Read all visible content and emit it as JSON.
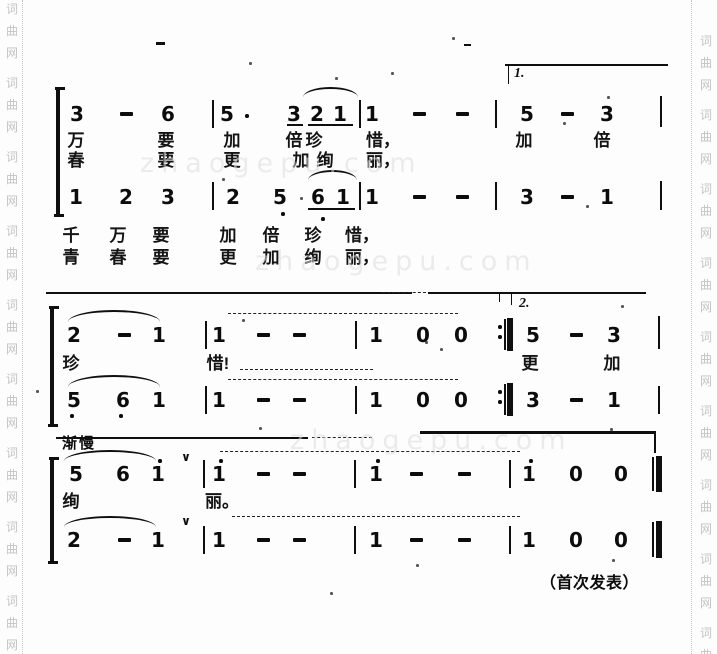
{
  "meta": {
    "footer": "（首次发表）",
    "volta1": "1.",
    "volta2": "2.",
    "tempo": "渐慢",
    "breath": "∨",
    "site_watermark": "词曲网",
    "diagonal_watermark": "zhaogepu.com"
  },
  "watermark": {
    "chars": [
      "词",
      "曲",
      "网"
    ],
    "left": {
      "x": 4,
      "start": 2,
      "step": 74,
      "gap": 22,
      "groups": 9
    },
    "right": {
      "x": 698,
      "start": 34,
      "step": 74,
      "gap": 22,
      "groups": 9
    }
  },
  "score": {
    "rows": [
      {
        "n": "s1-voice1",
        "cls": "num",
        "y": 103,
        "tokens": [
          {
            "t": "3",
            "x": 77
          },
          {
            "t": "-",
            "x": 126
          },
          {
            "t": "6",
            "x": 168
          },
          {
            "t": "5",
            "x": 227
          },
          {
            "t": "3",
            "x": 294
          },
          {
            "t": "2",
            "x": 317
          },
          {
            "t": "1",
            "x": 340
          },
          {
            "t": "1",
            "x": 372
          },
          {
            "t": "-",
            "x": 419
          },
          {
            "t": "-",
            "x": 462
          },
          {
            "t": "5",
            "x": 527
          },
          {
            "t": "-",
            "x": 567
          },
          {
            "t": "3",
            "x": 607
          }
        ]
      },
      {
        "n": "s1-lyric-1",
        "cls": "lyr",
        "y": 131,
        "tokens": [
          {
            "t": "万",
            "x": 76
          },
          {
            "t": "要",
            "x": 166
          },
          {
            "t": "加",
            "x": 232
          },
          {
            "t": "倍",
            "x": 294
          },
          {
            "t": "珍",
            "x": 314
          },
          {
            "t": "惜，",
            "x": 383
          },
          {
            "t": "加",
            "x": 524
          },
          {
            "t": "倍",
            "x": 602
          }
        ]
      },
      {
        "n": "s1-lyric-2",
        "cls": "lyr",
        "y": 151,
        "tokens": [
          {
            "t": "春",
            "x": 76
          },
          {
            "t": "要",
            "x": 166
          },
          {
            "t": "更",
            "x": 232
          },
          {
            "t": "加",
            "x": 301
          },
          {
            "t": "绚",
            "x": 325
          },
          {
            "t": "丽，",
            "x": 383
          }
        ]
      },
      {
        "n": "s1-voice2",
        "cls": "num",
        "y": 186,
        "tokens": [
          {
            "t": "1",
            "x": 76
          },
          {
            "t": "2",
            "x": 126
          },
          {
            "t": "3",
            "x": 168
          },
          {
            "t": "2",
            "x": 233
          },
          {
            "t": "5",
            "x": 280
          },
          {
            "t": "6",
            "x": 318
          },
          {
            "t": "1",
            "x": 343
          },
          {
            "t": "1",
            "x": 372
          },
          {
            "t": "-",
            "x": 419
          },
          {
            "t": "-",
            "x": 462
          },
          {
            "t": "3",
            "x": 527
          },
          {
            "t": "-",
            "x": 567
          },
          {
            "t": "1",
            "x": 607
          }
        ]
      },
      {
        "n": "s1-lyric-3",
        "cls": "lyr",
        "y": 226,
        "tokens": [
          {
            "t": "千",
            "x": 71
          },
          {
            "t": "万",
            "x": 118
          },
          {
            "t": "要",
            "x": 161
          },
          {
            "t": "加",
            "x": 228
          },
          {
            "t": "倍",
            "x": 271
          },
          {
            "t": "珍",
            "x": 313
          },
          {
            "t": "惜，",
            "x": 362
          }
        ]
      },
      {
        "n": "s1-lyric-4",
        "cls": "lyr",
        "y": 248,
        "tokens": [
          {
            "t": "青",
            "x": 71
          },
          {
            "t": "春",
            "x": 118
          },
          {
            "t": "要",
            "x": 161
          },
          {
            "t": "更",
            "x": 228
          },
          {
            "t": "加",
            "x": 271
          },
          {
            "t": "绚",
            "x": 313
          },
          {
            "t": "丽，",
            "x": 362
          }
        ]
      },
      {
        "n": "s2-voice1",
        "cls": "num",
        "y": 324,
        "tokens": [
          {
            "t": "2",
            "x": 74
          },
          {
            "t": "-",
            "x": 124
          },
          {
            "t": "1",
            "x": 159
          },
          {
            "t": "1",
            "x": 219
          },
          {
            "t": "-",
            "x": 263
          },
          {
            "t": "-",
            "x": 299
          },
          {
            "t": "1",
            "x": 376
          },
          {
            "t": "0",
            "x": 423
          },
          {
            "t": "0",
            "x": 461
          },
          {
            "t": "5",
            "x": 533
          },
          {
            "t": "-",
            "x": 576
          },
          {
            "t": "3",
            "x": 614
          }
        ]
      },
      {
        "n": "s2-lyric",
        "cls": "lyr",
        "y": 354,
        "tokens": [
          {
            "t": "珍",
            "x": 71
          },
          {
            "t": "惜!",
            "x": 218
          },
          {
            "t": "更",
            "x": 530
          },
          {
            "t": "加",
            "x": 612
          }
        ]
      },
      {
        "n": "s2-voice2",
        "cls": "num",
        "y": 389,
        "tokens": [
          {
            "t": "5",
            "x": 74
          },
          {
            "t": "6",
            "x": 123
          },
          {
            "t": "1",
            "x": 159
          },
          {
            "t": "1",
            "x": 219
          },
          {
            "t": "-",
            "x": 263
          },
          {
            "t": "-",
            "x": 299
          },
          {
            "t": "1",
            "x": 376
          },
          {
            "t": "0",
            "x": 423
          },
          {
            "t": "0",
            "x": 461
          },
          {
            "t": "3",
            "x": 533
          },
          {
            "t": "-",
            "x": 576
          },
          {
            "t": "1",
            "x": 614
          }
        ]
      },
      {
        "n": "s3-voice1",
        "cls": "num",
        "y": 463,
        "tokens": [
          {
            "t": "5",
            "x": 76
          },
          {
            "t": "6",
            "x": 123
          },
          {
            "t": "1",
            "x": 158
          },
          {
            "t": "1",
            "x": 219
          },
          {
            "t": "-",
            "x": 263
          },
          {
            "t": "-",
            "x": 299
          },
          {
            "t": "1",
            "x": 376
          },
          {
            "t": "-",
            "x": 416
          },
          {
            "t": "-",
            "x": 464
          },
          {
            "t": "1",
            "x": 529
          },
          {
            "t": "0",
            "x": 576
          },
          {
            "t": "0",
            "x": 621
          }
        ]
      },
      {
        "n": "s3-lyric",
        "cls": "lyr",
        "y": 492,
        "tokens": [
          {
            "t": "绚",
            "x": 71
          },
          {
            "t": "丽。",
            "x": 222
          }
        ]
      },
      {
        "n": "s3-voice2",
        "cls": "num",
        "y": 529,
        "tokens": [
          {
            "t": "2",
            "x": 74
          },
          {
            "t": "-",
            "x": 124
          },
          {
            "t": "1",
            "x": 158
          },
          {
            "t": "1",
            "x": 219
          },
          {
            "t": "-",
            "x": 263
          },
          {
            "t": "-",
            "x": 299
          },
          {
            "t": "1",
            "x": 376
          },
          {
            "t": "-",
            "x": 416
          },
          {
            "t": "-",
            "x": 464
          },
          {
            "t": "1",
            "x": 529
          },
          {
            "t": "0",
            "x": 576
          },
          {
            "t": "0",
            "x": 621
          }
        ]
      }
    ],
    "marks": [
      {
        "ty": "v",
        "x": 56,
        "y": 89,
        "w": 4,
        "h": 127,
        "n": "voice-brace"
      },
      {
        "ty": "h",
        "x": 55,
        "y": 87,
        "w": 10,
        "h": 2.5,
        "n": "brace-hook"
      },
      {
        "ty": "h",
        "x": 54,
        "y": 214,
        "w": 10,
        "h": 2.5,
        "n": "brace-hook"
      },
      {
        "ty": "v",
        "x": 212,
        "y": 100,
        "h": 28
      },
      {
        "ty": "v",
        "x": 359,
        "y": 100,
        "h": 28
      },
      {
        "ty": "v",
        "x": 495,
        "y": 100,
        "h": 28
      },
      {
        "ty": "v",
        "x": 660,
        "y": 96,
        "h": 31
      },
      {
        "ty": "v",
        "x": 212,
        "y": 182,
        "h": 28
      },
      {
        "ty": "v",
        "x": 359,
        "y": 182,
        "h": 28
      },
      {
        "ty": "v",
        "x": 495,
        "y": 182,
        "h": 28
      },
      {
        "ty": "v",
        "x": 660,
        "y": 181,
        "h": 29
      },
      {
        "ty": "h",
        "x": 505,
        "y": 64,
        "w": 163,
        "h": 2,
        "n": "volta-bracket"
      },
      {
        "ty": "v",
        "x": 508,
        "y": 66,
        "w": 1.2,
        "h": 18,
        "n": "volta-bracket"
      },
      {
        "ty": "h",
        "x": 287,
        "y": 124,
        "w": 16,
        "h": 2,
        "n": "beam-underline"
      },
      {
        "ty": "h",
        "x": 308,
        "y": 124,
        "w": 45,
        "h": 2,
        "n": "beam-underline"
      },
      {
        "ty": "h",
        "x": 308,
        "y": 208,
        "w": 47,
        "h": 2,
        "n": "beam-underline"
      },
      {
        "ty": "a",
        "x": 303,
        "y": 87,
        "w": 55,
        "h": 11
      },
      {
        "ty": "a",
        "x": 308,
        "y": 170,
        "w": 49,
        "h": 11
      },
      {
        "ty": "d",
        "x": 245,
        "y": 114,
        "n": "augmentation-dot"
      },
      {
        "ty": "d",
        "x": 281,
        "y": 212,
        "n": "octave-dot-low"
      },
      {
        "ty": "d",
        "x": 321,
        "y": 217,
        "n": "octave-dot-low"
      },
      {
        "ty": "h",
        "x": 156,
        "y": 42,
        "w": 9,
        "h": 2.5,
        "n": "stray-mark"
      },
      {
        "ty": "h",
        "x": 464,
        "y": 44,
        "w": 7,
        "h": 2,
        "n": "stray-mark"
      },
      {
        "ty": "h",
        "x": 46,
        "y": 292,
        "w": 366,
        "h": 2,
        "n": "separator-line"
      },
      {
        "ty": "h",
        "x": 382,
        "y": 292,
        "w": 44,
        "h": 1.5,
        "d": 1,
        "n": "separator-line"
      },
      {
        "ty": "h",
        "x": 428,
        "y": 292,
        "w": 218,
        "h": 2,
        "n": "separator-line"
      },
      {
        "ty": "v",
        "x": 499,
        "y": 294,
        "w": 1.2,
        "h": 8,
        "n": "volta-bracket"
      },
      {
        "ty": "v",
        "x": 511,
        "y": 294,
        "w": 1.2,
        "h": 11,
        "n": "volta-bracket"
      },
      {
        "ty": "v",
        "x": 50,
        "y": 308,
        "w": 4,
        "h": 118,
        "n": "voice-brace"
      },
      {
        "ty": "h",
        "x": 49,
        "y": 306,
        "w": 10,
        "h": 2.5,
        "n": "brace-hook"
      },
      {
        "ty": "h",
        "x": 48,
        "y": 424,
        "w": 10,
        "h": 2.5,
        "n": "brace-hook"
      },
      {
        "ty": "v",
        "x": 205,
        "y": 321,
        "h": 28
      },
      {
        "ty": "v",
        "x": 355,
        "y": 321,
        "h": 28
      },
      {
        "ty": "v",
        "x": 658,
        "y": 316,
        "h": 33
      },
      {
        "ty": "v",
        "x": 205,
        "y": 386,
        "h": 28
      },
      {
        "ty": "v",
        "x": 355,
        "y": 386,
        "h": 28
      },
      {
        "ty": "v",
        "x": 658,
        "y": 386,
        "h": 28
      },
      {
        "ty": "v",
        "x": 504,
        "y": 319,
        "h": 31,
        "n": "repeat-barline"
      },
      {
        "ty": "v",
        "x": 507,
        "y": 318,
        "w": 5.5,
        "h": 33,
        "n": "repeat-barline"
      },
      {
        "ty": "d",
        "x": 498,
        "y": 325,
        "n": "repeat-dot"
      },
      {
        "ty": "d",
        "x": 498,
        "y": 335,
        "n": "repeat-dot"
      },
      {
        "ty": "v",
        "x": 504,
        "y": 384,
        "h": 31,
        "n": "repeat-barline"
      },
      {
        "ty": "v",
        "x": 507,
        "y": 383,
        "w": 5.5,
        "h": 33,
        "n": "repeat-barline"
      },
      {
        "ty": "d",
        "x": 498,
        "y": 390,
        "n": "repeat-dot"
      },
      {
        "ty": "d",
        "x": 498,
        "y": 400,
        "n": "repeat-dot"
      },
      {
        "ty": "a",
        "x": 68,
        "y": 310,
        "w": 92,
        "h": 13
      },
      {
        "ty": "a",
        "x": 68,
        "y": 375,
        "w": 92,
        "h": 13
      },
      {
        "ty": "d",
        "x": 70,
        "y": 414,
        "n": "octave-dot-low"
      },
      {
        "ty": "d",
        "x": 119,
        "y": 414,
        "n": "octave-dot-low"
      },
      {
        "ty": "h",
        "x": 228,
        "y": 313,
        "w": 230,
        "h": 1.5,
        "d": 1,
        "n": "tie"
      },
      {
        "ty": "h",
        "x": 240,
        "y": 369,
        "w": 133,
        "h": 1.5,
        "d": 1,
        "n": "lyric-extension"
      },
      {
        "ty": "h",
        "x": 228,
        "y": 379,
        "w": 230,
        "h": 1.5,
        "d": 1,
        "n": "tie"
      },
      {
        "ty": "h",
        "x": 56,
        "y": 437,
        "w": 252,
        "h": 2,
        "n": "separator-line"
      },
      {
        "ty": "h",
        "x": 312,
        "y": 437,
        "w": 60,
        "h": 1.5,
        "d": 1,
        "n": "separator-line"
      },
      {
        "ty": "h",
        "x": 420,
        "y": 431,
        "w": 236,
        "h": 2.5,
        "n": "separator-line"
      },
      {
        "ty": "v",
        "x": 654,
        "y": 431,
        "w": 2,
        "h": 22,
        "n": "separator-hook"
      },
      {
        "ty": "v",
        "x": 50,
        "y": 459,
        "w": 4,
        "h": 104,
        "n": "voice-brace"
      },
      {
        "ty": "h",
        "x": 49,
        "y": 457,
        "w": 10,
        "h": 2.5,
        "n": "brace-hook"
      },
      {
        "ty": "h",
        "x": 48,
        "y": 561,
        "w": 10,
        "h": 2.5,
        "n": "brace-hook"
      },
      {
        "ty": "d",
        "x": 158,
        "y": 459,
        "n": "octave-dot-high"
      },
      {
        "ty": "d",
        "x": 219,
        "y": 459,
        "n": "octave-dot-high"
      },
      {
        "ty": "d",
        "x": 376,
        "y": 459,
        "n": "octave-dot-high"
      },
      {
        "ty": "d",
        "x": 529,
        "y": 459,
        "n": "octave-dot-high"
      },
      {
        "ty": "a",
        "x": 64,
        "y": 450,
        "w": 92,
        "h": 12
      },
      {
        "ty": "a",
        "x": 64,
        "y": 516,
        "w": 92,
        "h": 12
      },
      {
        "ty": "v",
        "x": 203,
        "y": 460,
        "h": 28
      },
      {
        "ty": "v",
        "x": 354,
        "y": 460,
        "h": 28
      },
      {
        "ty": "v",
        "x": 509,
        "y": 460,
        "h": 28
      },
      {
        "ty": "v",
        "x": 203,
        "y": 526,
        "h": 28
      },
      {
        "ty": "v",
        "x": 354,
        "y": 526,
        "h": 28
      },
      {
        "ty": "v",
        "x": 509,
        "y": 526,
        "h": 28
      },
      {
        "ty": "v",
        "x": 652,
        "y": 457,
        "h": 34,
        "n": "final-barline"
      },
      {
        "ty": "v",
        "x": 656,
        "y": 456,
        "w": 6,
        "h": 36,
        "n": "final-barline"
      },
      {
        "ty": "v",
        "x": 652,
        "y": 522,
        "h": 35,
        "n": "final-barline"
      },
      {
        "ty": "v",
        "x": 656,
        "y": 521,
        "w": 6,
        "h": 37,
        "n": "final-barline"
      },
      {
        "ty": "h",
        "x": 220,
        "y": 451,
        "w": 300,
        "h": 1.5,
        "d": 1,
        "n": "tie"
      },
      {
        "ty": "h",
        "x": 232,
        "y": 516,
        "w": 288,
        "h": 1.5,
        "d": 1,
        "n": "tie"
      }
    ]
  },
  "noise": [
    [
      249,
      62
    ],
    [
      335,
      77
    ],
    [
      391,
      72
    ],
    [
      452,
      37
    ],
    [
      222,
      178
    ],
    [
      607,
      96
    ],
    [
      563,
      122
    ],
    [
      300,
      197
    ],
    [
      610,
      428
    ],
    [
      440,
      348
    ],
    [
      621,
      305
    ],
    [
      242,
      319
    ],
    [
      425,
      341
    ],
    [
      259,
      427
    ],
    [
      416,
      564
    ],
    [
      612,
      559
    ],
    [
      36,
      390
    ],
    [
      330,
      592
    ],
    [
      586,
      205
    ],
    [
      158,
      230
    ]
  ]
}
